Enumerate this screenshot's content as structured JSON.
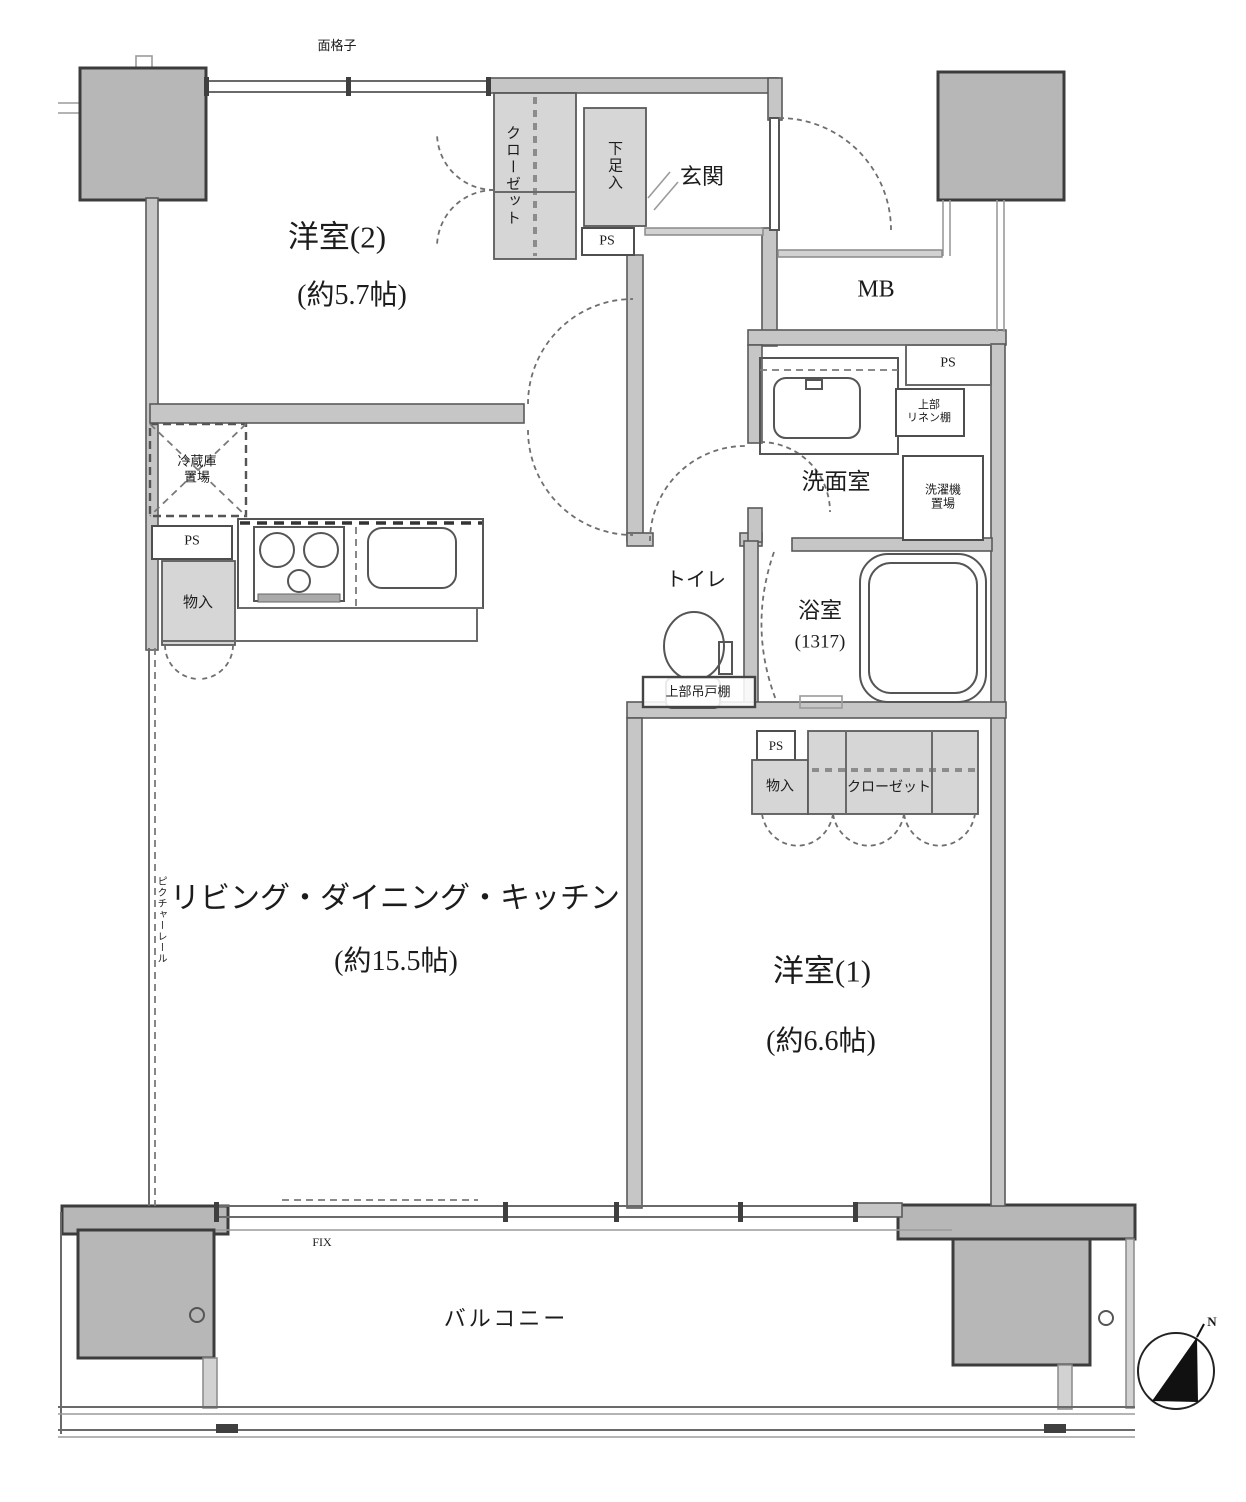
{
  "colors": {
    "wall_fill": "#c6c6c6",
    "wall_edge": "#5a5a5a",
    "pillar_fill": "#b7b7b7",
    "gray_box": "#d6d6d6",
    "line": "#555555",
    "text": "#1c1c1c",
    "compass_needle": "#111111"
  },
  "rooms": {
    "western2": {
      "name": "洋室(2)",
      "size": "(約5.7帖)"
    },
    "ldk": {
      "name": "リビング・ダイニング・キッチン",
      "size": "(約15.5帖)"
    },
    "western1": {
      "name": "洋室(1)",
      "size": "(約6.6帖)"
    },
    "entrance": {
      "name": "玄関"
    },
    "washroom": {
      "name": "洗面室"
    },
    "toilet": {
      "name": "トイレ"
    },
    "bath": {
      "name": "浴室",
      "size": "(1317)"
    },
    "balcony": {
      "name": "バルコニー"
    }
  },
  "labels": {
    "lattice": "面格子",
    "closet": "クローゼット",
    "shoe_cabinet": "下足入",
    "pipe_space": "PS",
    "meter_box": "MB",
    "linen_shelf": [
      "上部",
      "リネン棚"
    ],
    "washer_space": [
      "洗濯機",
      "置場"
    ],
    "fridge_space": [
      "冷蔵庫",
      "置場"
    ],
    "storage": "物入",
    "upper_cabinet": "上部吊戸棚",
    "picture_rail": "ピクチャーレール",
    "fixed_window": "FIX",
    "compass_north": "N"
  }
}
